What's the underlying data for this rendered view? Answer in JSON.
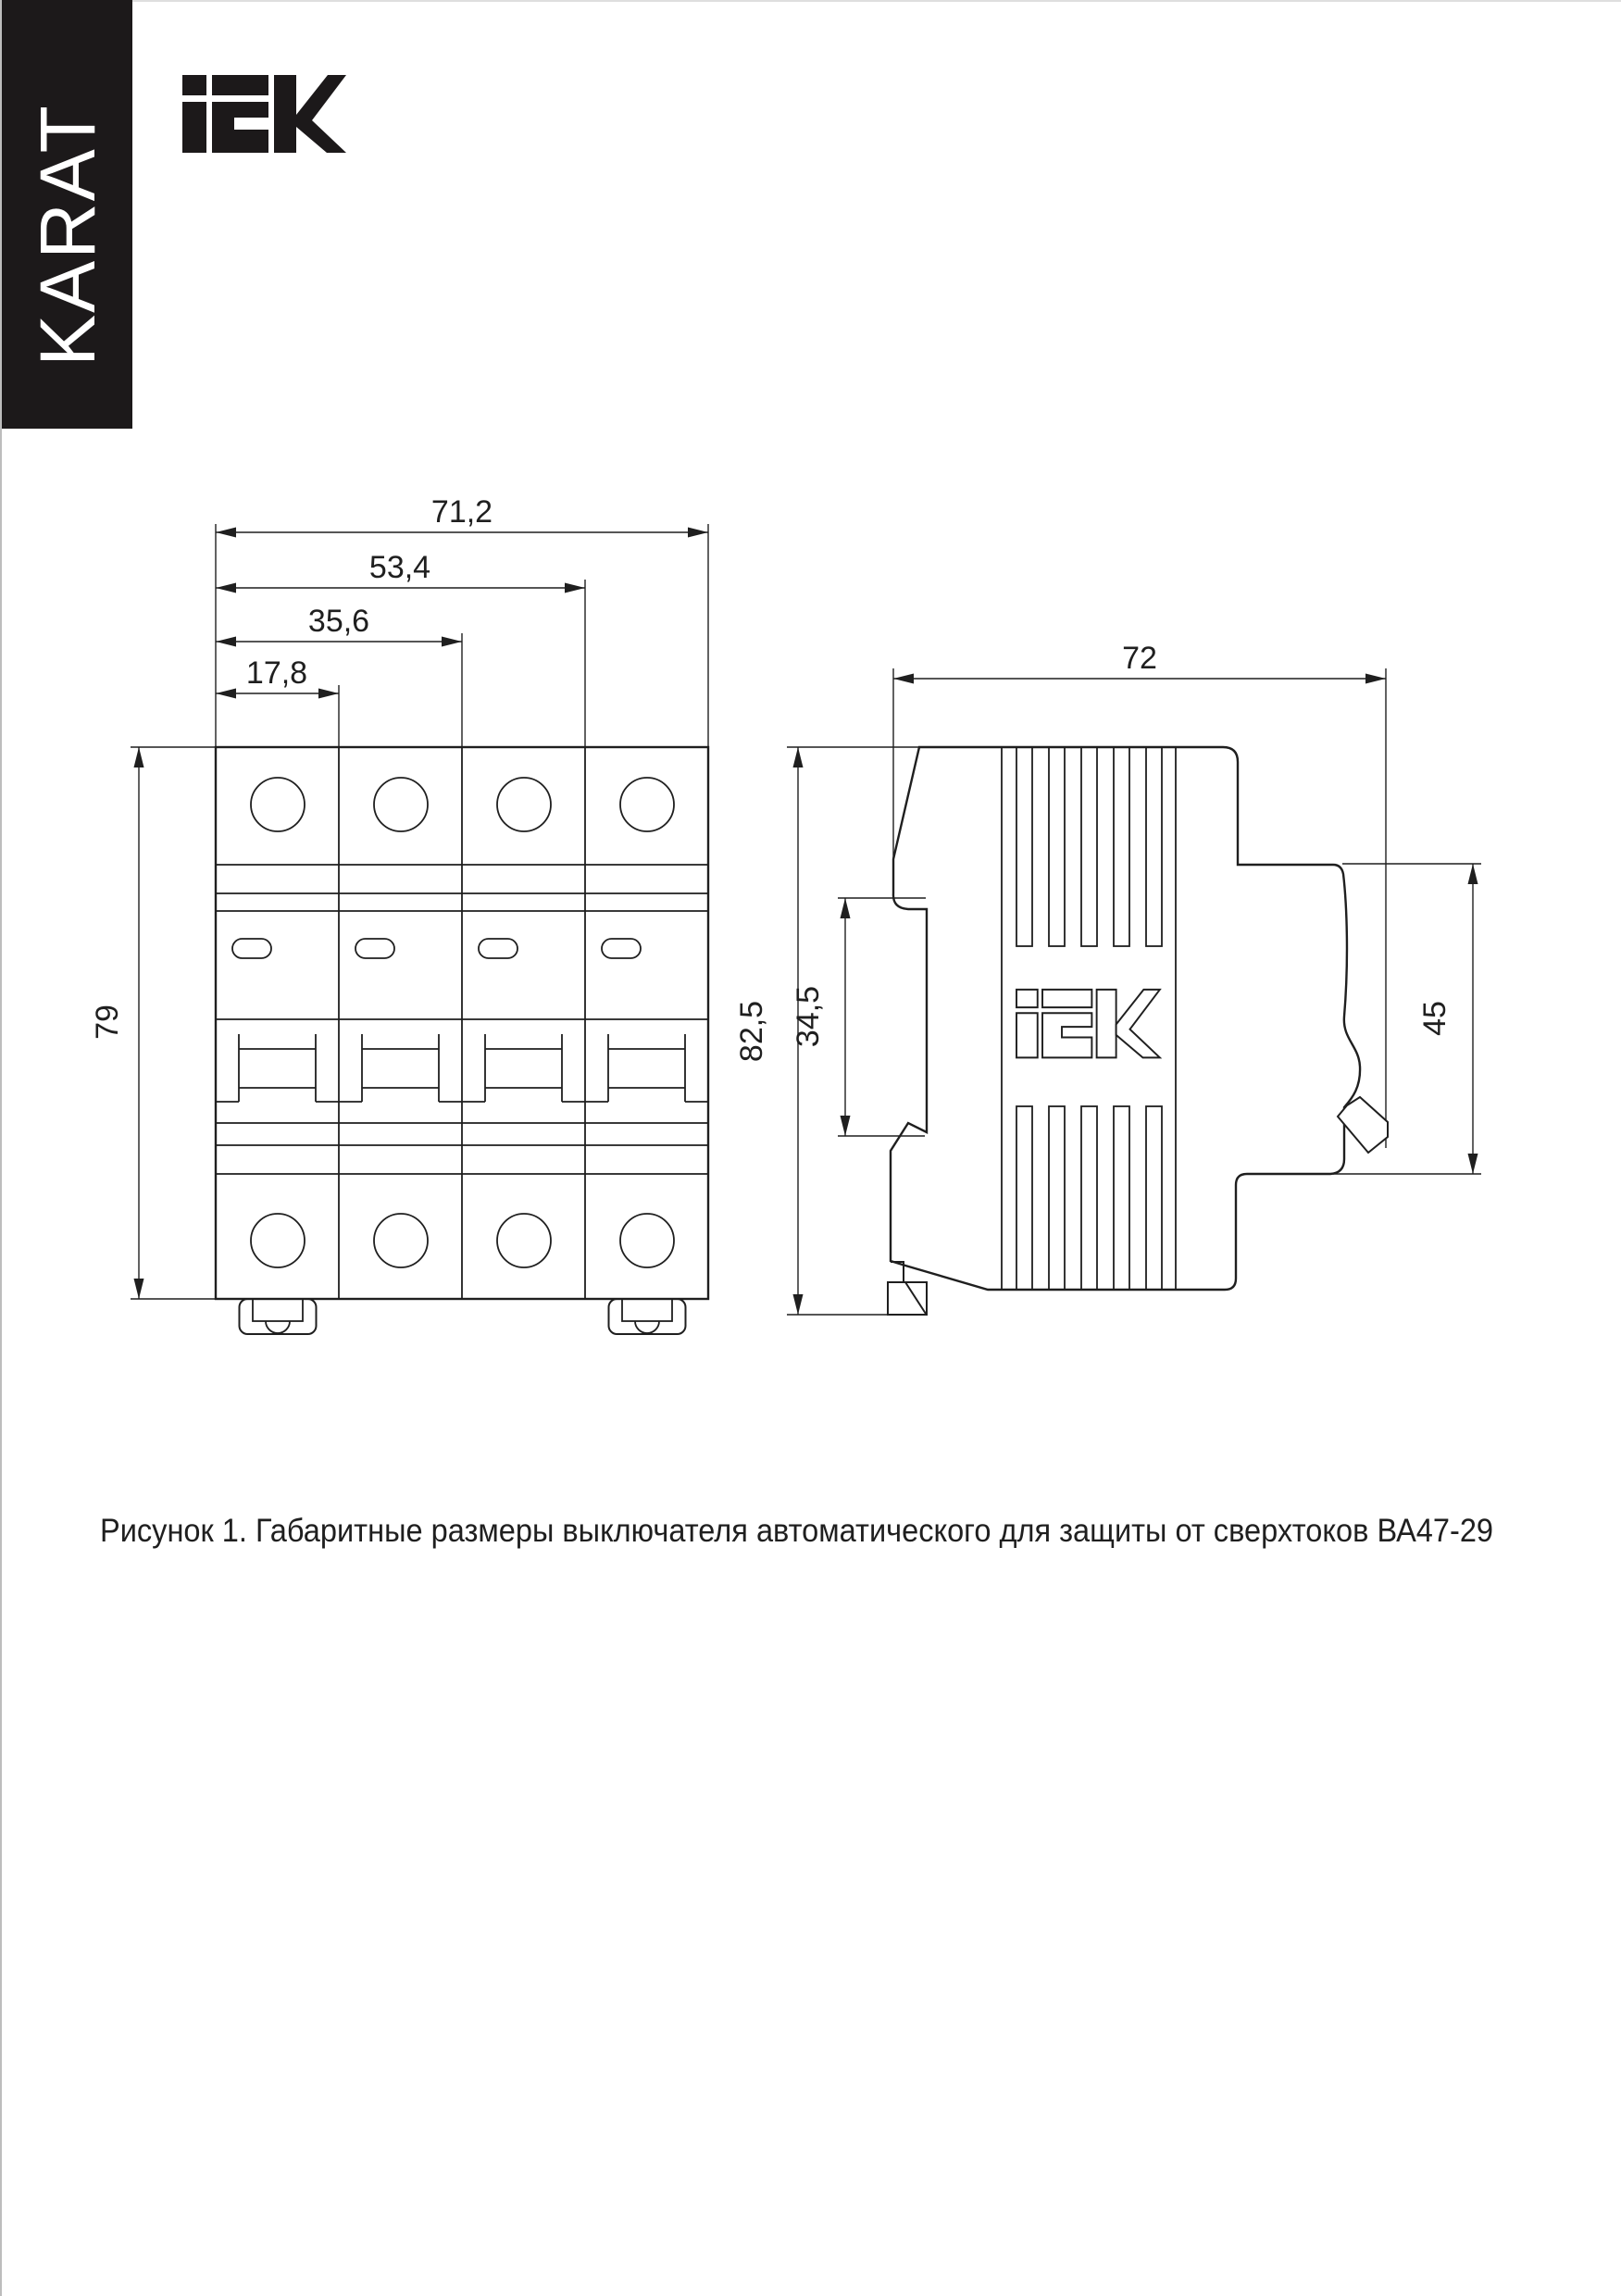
{
  "page": {
    "background": "#ffffff",
    "line_color": "#1f1f1f",
    "edge_line_color": "#9a9a9a"
  },
  "banner": {
    "label": "KARAT",
    "background": "#1c191a",
    "color": "#ffffff"
  },
  "header": {
    "logo": "IEK"
  },
  "front_view": {
    "label": "front view of 4-pole circuit breaker",
    "dims": {
      "total_width": "71,2",
      "three_modules": "53,4",
      "two_modules": "35,6",
      "one_module": "17,8",
      "height": "79"
    }
  },
  "side_view": {
    "label": "side view of circuit breaker",
    "embossed_logo": "IEK",
    "dims": {
      "depth": "72",
      "total_height": "82,5",
      "rail_recess": "34,5",
      "front_height": "45"
    }
  },
  "caption": {
    "text": "Рисунок 1. Габаритные размеры выключателя автоматического для защиты от сверхтоков ВА47-29"
  }
}
